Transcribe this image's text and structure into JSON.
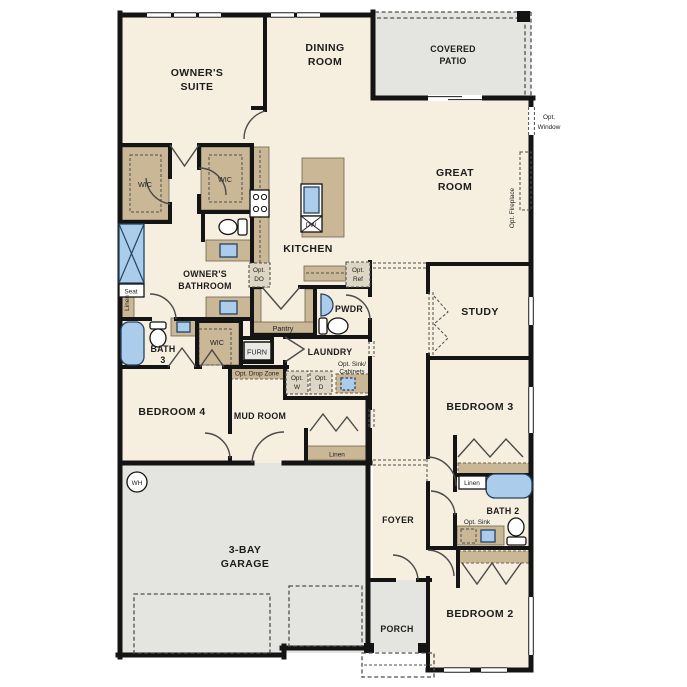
{
  "plan_colors": {
    "floor": "#f6eedf",
    "outdoor": "#e4e4e0",
    "wall": "#141414",
    "cabinet": "#c9b795",
    "fixture": "#abcdeb"
  },
  "rooms": {
    "owners_suite_1": "OWNER'S",
    "owners_suite_2": "SUITE",
    "dining_1": "DINING",
    "dining_2": "ROOM",
    "covered_patio_1": "COVERED",
    "covered_patio_2": "PATIO",
    "great_room_1": "GREAT",
    "great_room_2": "ROOM",
    "kitchen": "KITCHEN",
    "study": "STUDY",
    "owners_bathroom_1": "OWNER'S",
    "owners_bathroom_2": "BATHROOM",
    "bath3_1": "BATH",
    "bath3_2": "3",
    "bath2": "BATH 2",
    "pwdr": "PWDR",
    "laundry": "LAUNDRY",
    "pantry": "Pantry",
    "mud_room": "MUD ROOM",
    "bedroom2": "BEDROOM 2",
    "bedroom3": "BEDROOM 3",
    "bedroom4": "BEDROOM 4",
    "garage_1": "3-BAY",
    "garage_2": "GARAGE",
    "foyer": "FOYER",
    "porch": "PORCH",
    "wic": "WIC"
  },
  "closets": {
    "linen": "Linen",
    "seat": "Seat"
  },
  "equipment": {
    "furn": "FURN",
    "wh": "WH",
    "dw": "DW"
  },
  "options": {
    "window_1": "Opt.",
    "window_2": "Window",
    "fireplace": "Opt. Fireplace",
    "do_1": "Opt.",
    "do_2": "DO",
    "ref_1": "Opt.",
    "ref_2": "Ref",
    "w_1": "Opt.",
    "w_2": "W",
    "d_1": "Opt.",
    "d_2": "D",
    "sink_cabinets_1": "Opt. Sink/",
    "sink_cabinets_2": "Cabinets",
    "drop_zone": "Opt. Drop Zone",
    "sink": "Opt. Sink"
  }
}
